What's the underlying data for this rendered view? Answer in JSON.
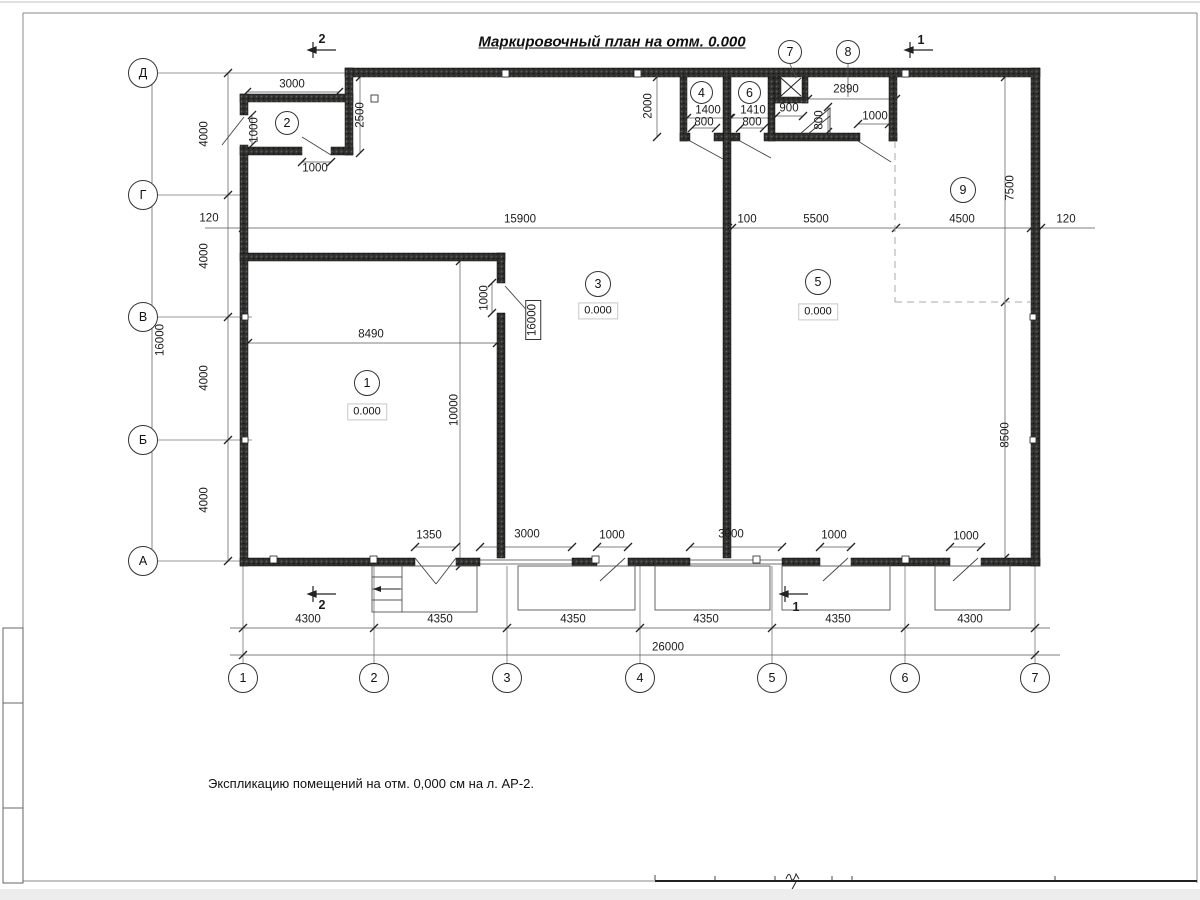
{
  "title": "Маркировочный план на отм. 0.000",
  "note": "Экспликацию помещений на отм. 0,000 см на л. АР-2.",
  "colors": {
    "wall": "#30302e",
    "line": "#444444",
    "dashed": "#999999"
  },
  "axes": {
    "rows": [
      "Д",
      "Г",
      "В",
      "Б",
      "А"
    ],
    "cols": [
      "1",
      "2",
      "3",
      "4",
      "5",
      "6",
      "7"
    ]
  },
  "rooms": {
    "r1": {
      "num": "1",
      "elev": "0.000"
    },
    "r2": {
      "num": "2"
    },
    "r3": {
      "num": "3",
      "elev": "0.000"
    },
    "r4": {
      "num": "4"
    },
    "r5": {
      "num": "5",
      "elev": "0.000"
    },
    "r6": {
      "num": "6"
    },
    "r7": {
      "num": "7"
    },
    "r8": {
      "num": "8"
    },
    "r9": {
      "num": "9"
    }
  },
  "sections": {
    "top_left": "2",
    "top_right": "1",
    "bottom_left": "2",
    "bottom_right": "1"
  },
  "dims": {
    "v4000": "4000",
    "v16000": "16000",
    "left_120": "120",
    "top_15900": "15900",
    "top_100": "100",
    "top_5500": "5500",
    "top_4500": "4500",
    "top_120": "120",
    "r2_3000": "3000",
    "r2_2500": "2500",
    "r2_door": "1000",
    "r2_door_bottom": "1000",
    "top_2000": "2000",
    "r4_1400": "1400",
    "r4_800": "800",
    "r6_1410": "1410",
    "r6_800": "800",
    "shaft_900": "900",
    "ramp_800": "800",
    "r8_2890": "2890",
    "r8_door": "1000",
    "r9_7500": "7500",
    "right_8500": "8500",
    "r1_8490": "8490",
    "r1_10000": "10000",
    "r1_door": "1000",
    "r1_16000": "16000",
    "b_1350": "1350",
    "b_3000a": "3000",
    "b_1000a": "1000",
    "b_3000b": "3000",
    "b_1000b": "1000",
    "b_1000c": "1000",
    "cols": [
      "4300",
      "4350",
      "4350",
      "4350",
      "4350",
      "4300"
    ],
    "total": "26000"
  }
}
